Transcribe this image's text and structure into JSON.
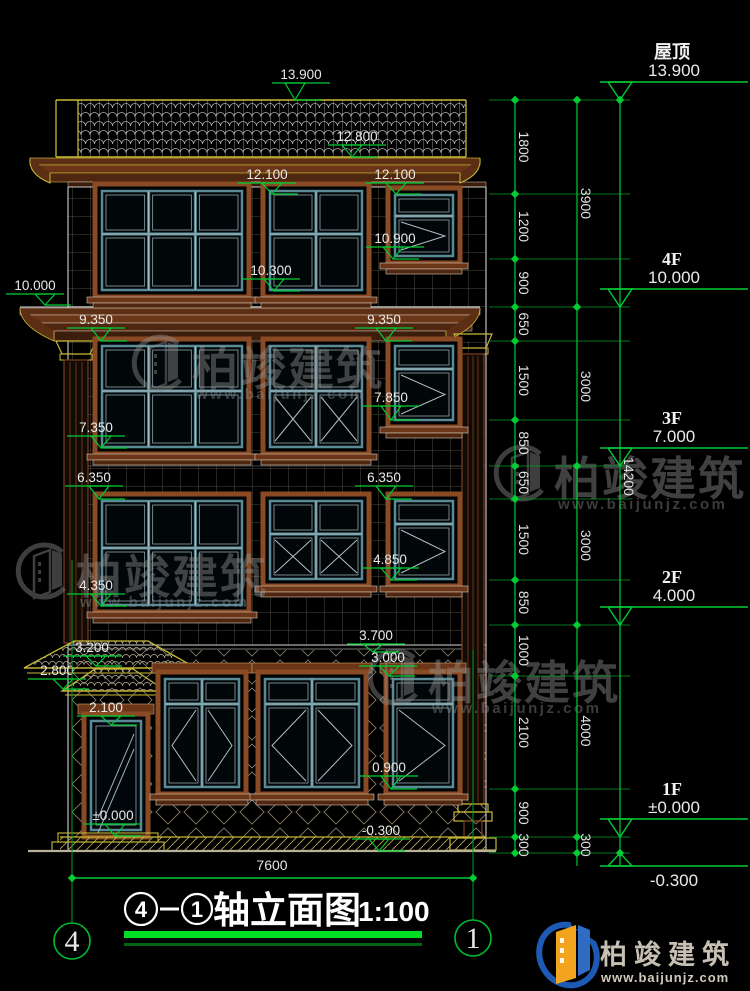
{
  "drawing_title": {
    "axis_start": "4",
    "axis_end": "1",
    "name": "轴立面图",
    "scale": "1:100"
  },
  "axis_bubbles": {
    "left": "4",
    "right": "1"
  },
  "bottom_dimension": "7600",
  "floor_levels": [
    {
      "label": "屋顶",
      "elevation": "13.900",
      "y": 100,
      "below": false
    },
    {
      "label": "4F",
      "elevation": "10.000",
      "y": 307,
      "below": false
    },
    {
      "label": "3F",
      "elevation": "7.000",
      "y": 466,
      "below": false
    },
    {
      "label": "2F",
      "elevation": "4.000",
      "y": 625,
      "below": false
    },
    {
      "label": "1F",
      "elevation": "±0.000",
      "y": 837,
      "below": false
    },
    {
      "label": "",
      "elevation": "-0.300",
      "y": 853,
      "below": true
    }
  ],
  "elevation_markers": [
    {
      "value": "13.900",
      "tx": 301,
      "ty": 79,
      "ax": 295,
      "ay": 100
    },
    {
      "value": "12.800",
      "tx": 357,
      "ty": 141,
      "ax": 352,
      "ay": 157
    },
    {
      "value": "12.100",
      "tx": 267,
      "ty": 179,
      "ax": 272,
      "ay": 194
    },
    {
      "value": "12.100",
      "tx": 395,
      "ty": 179,
      "ax": 396,
      "ay": 194
    },
    {
      "value": "10.900",
      "tx": 395,
      "ty": 243,
      "ax": 393,
      "ay": 259
    },
    {
      "value": "10.300",
      "tx": 271,
      "ty": 275,
      "ax": 274,
      "ay": 291
    },
    {
      "value": "10.000",
      "tx": 35,
      "ty": 290,
      "ax": 45,
      "ay": 305
    },
    {
      "value": "9.350",
      "tx": 96,
      "ty": 324,
      "ax": 101,
      "ay": 341
    },
    {
      "value": "9.350",
      "tx": 384,
      "ty": 324,
      "ax": 386,
      "ay": 341
    },
    {
      "value": "7.850",
      "tx": 391,
      "ty": 402,
      "ax": 391,
      "ay": 420
    },
    {
      "value": "7.350",
      "tx": 96,
      "ty": 432,
      "ax": 101,
      "ay": 448
    },
    {
      "value": "6.350",
      "tx": 94,
      "ty": 482,
      "ax": 99,
      "ay": 499
    },
    {
      "value": "6.350",
      "tx": 384,
      "ty": 482,
      "ax": 386,
      "ay": 499
    },
    {
      "value": "4.850",
      "tx": 390,
      "ty": 564,
      "ax": 391,
      "ay": 580
    },
    {
      "value": "4.350",
      "tx": 96,
      "ty": 590,
      "ax": 101,
      "ay": 606
    },
    {
      "value": "3.700",
      "tx": 376,
      "ty": 640,
      "ax": 373,
      "ay": 652
    },
    {
      "value": "3.200",
      "tx": 92,
      "ty": 652,
      "ax": 96,
      "ay": 666
    },
    {
      "value": "3.000",
      "tx": 388,
      "ty": 662,
      "ax": 389,
      "ay": 676
    },
    {
      "value": "2.800",
      "tx": 57,
      "ty": 675,
      "ax": 63,
      "ay": 689
    },
    {
      "value": "2.100",
      "tx": 106,
      "ty": 712,
      "ax": 111,
      "ay": 725
    },
    {
      "value": "0.900",
      "tx": 389,
      "ty": 772,
      "ax": 391,
      "ay": 789
    },
    {
      "value": "±0.000",
      "tx": 113,
      "ty": 820,
      "ax": 115,
      "ay": 836
    },
    {
      "value": "-0.300",
      "tx": 381,
      "ty": 835,
      "ax": 379,
      "ay": 851
    }
  ],
  "dimension_chains": [
    {
      "x": 515,
      "nodes": [
        100,
        194,
        259,
        307,
        341,
        420,
        466,
        499,
        580,
        625,
        676,
        789,
        837,
        853
      ],
      "labels": [
        "1800",
        "1200",
        "900",
        "650",
        "1500",
        "850",
        "650",
        "1500",
        "850",
        "1000",
        "2100",
        "900",
        "300"
      ]
    },
    {
      "x": 577,
      "nodes": [
        100,
        307,
        466,
        625,
        837,
        853
      ],
      "labels": [
        "3900",
        "3000",
        "3000",
        "4000",
        "300"
      ]
    },
    {
      "x": 620,
      "nodes": [
        100,
        853
      ],
      "labels": [
        "14200"
      ]
    }
  ],
  "watermark": {
    "text": "柏竣建筑",
    "url": "www.baijunjz.com",
    "positions": [
      {
        "x": 130,
        "y": 336
      },
      {
        "x": 492,
        "y": 446
      },
      {
        "x": 14,
        "y": 544
      },
      {
        "x": 366,
        "y": 650
      }
    ]
  },
  "logo": {
    "name": "柏竣建筑",
    "url": "www.baijunjz.com"
  },
  "colors": {
    "dimension_green": "#00cc33",
    "text_white": "#e9e9e9",
    "frame_brown": "#8a4a24",
    "sash_teal": "#5a8a96",
    "accent_yellow": "#c8b838"
  }
}
